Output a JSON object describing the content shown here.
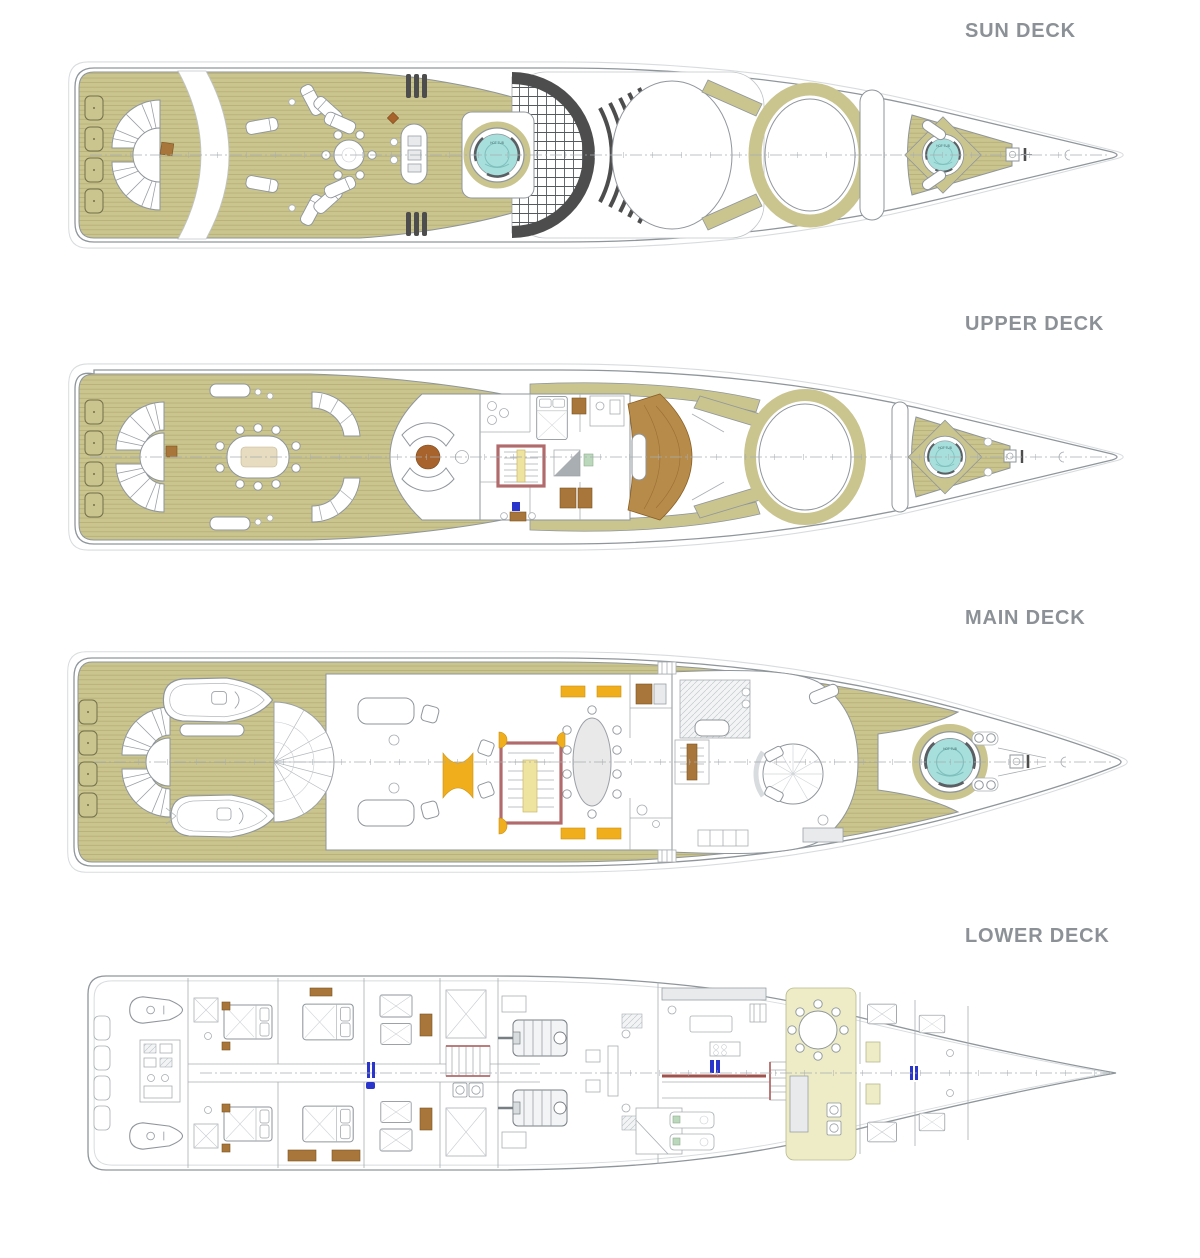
{
  "decks": [
    {
      "id": "sun-deck",
      "label": "SUN DECK"
    },
    {
      "id": "upper-deck",
      "label": "UPPER DECK"
    },
    {
      "id": "main-deck",
      "label": "MAIN DECK"
    },
    {
      "id": "lower-deck",
      "label": "LOWER DECK"
    }
  ],
  "annotations": {
    "hot_tub": "HOT TUB"
  },
  "colors": {
    "teak": "#cac48f",
    "teak-line": "#b3ab72",
    "outline": "#8f969b",
    "ghost": "#d8dcde",
    "hottub": "#a7dfdd",
    "wood": "#a8763b",
    "wood-dark": "#a8622b",
    "accent-yellow": "#f0ae1c",
    "stair-red": "#b26b6c",
    "pale-room": "#edecc7",
    "accent-blue": "#2a35cb",
    "dark": "#4d4d4d",
    "label": "#8b9196"
  }
}
